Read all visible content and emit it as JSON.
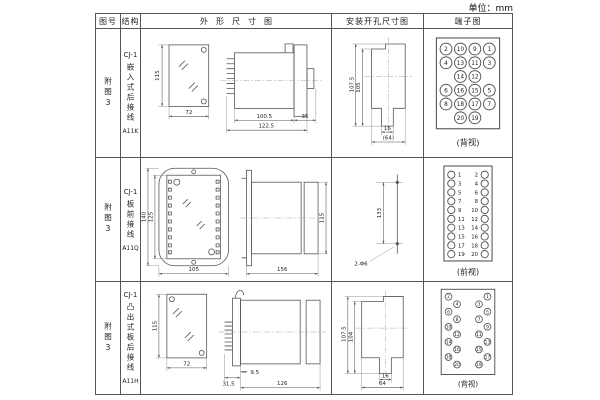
{
  "page": {
    "unit_label": "单位：mm"
  },
  "headers": {
    "figure_no": "图号",
    "structure": "结构",
    "outline": "外形尺寸图",
    "install": "安装开孔尺寸图",
    "terminal": "端子图"
  },
  "rows": [
    {
      "figure_no": "附图3",
      "model": "CJ-1",
      "mount_type": "嵌入式后接线",
      "code": "A11K",
      "outline": {
        "front_height": "115",
        "front_width": "72",
        "body_depth": "100.5",
        "total_depth": "122.5",
        "flange_depth": "35"
      },
      "install": {
        "outer_height": "107.5",
        "inner_height": "105",
        "slot_width": "16",
        "opening_width": "(64)"
      },
      "terminal": {
        "view_label": "(背视)",
        "layout": "grid4",
        "rows": [
          [
            "2",
            "10",
            "9",
            "1"
          ],
          [
            "4",
            "13",
            "11",
            "3"
          ],
          [
            "14",
            "12"
          ],
          [
            "6",
            "16",
            "15",
            "5"
          ],
          [
            "8",
            "18",
            "17",
            "7"
          ],
          [
            "20",
            "19"
          ]
        ]
      }
    },
    {
      "figure_no": "附图3",
      "model": "CJ-1",
      "mount_type": "板前接线",
      "code": "A11Q",
      "outline": {
        "front_outer_height": "140",
        "front_inner_height": "125",
        "front_width": "105",
        "body_length": "156",
        "body_height": "115"
      },
      "install": {
        "hole_spacing": "133",
        "hole_spec": "2-Φ6"
      },
      "terminal": {
        "view_label": "(前视)",
        "layout": "cols2",
        "left": [
          "1",
          "3",
          "5",
          "7",
          "9",
          "11",
          "13",
          "15",
          "17",
          "19"
        ],
        "right": [
          "2",
          "4",
          "6",
          "8",
          "10",
          "12",
          "14",
          "16",
          "18",
          "20"
        ]
      }
    },
    {
      "figure_no": "附图3",
      "model": "CJ-1",
      "mount_type": "凸出式板后接线",
      "code": "A11H",
      "outline": {
        "front_height": "115",
        "front_width": "72",
        "pin_depth": "31.5",
        "step_depth": "9.5",
        "body_depth": "126"
      },
      "install": {
        "outer_height": "107.5",
        "inner_height": "104",
        "slot_width": "16",
        "opening_width": "64"
      },
      "terminal": {
        "view_label": "(背视)",
        "layout": "staggered",
        "left": [
          "2",
          "4",
          "6",
          "8",
          "10",
          "12",
          "14",
          "16",
          "18",
          "20"
        ],
        "right": [
          "1",
          "3",
          "5",
          "7",
          "9",
          "11",
          "13",
          "15",
          "17",
          "19"
        ]
      }
    }
  ]
}
